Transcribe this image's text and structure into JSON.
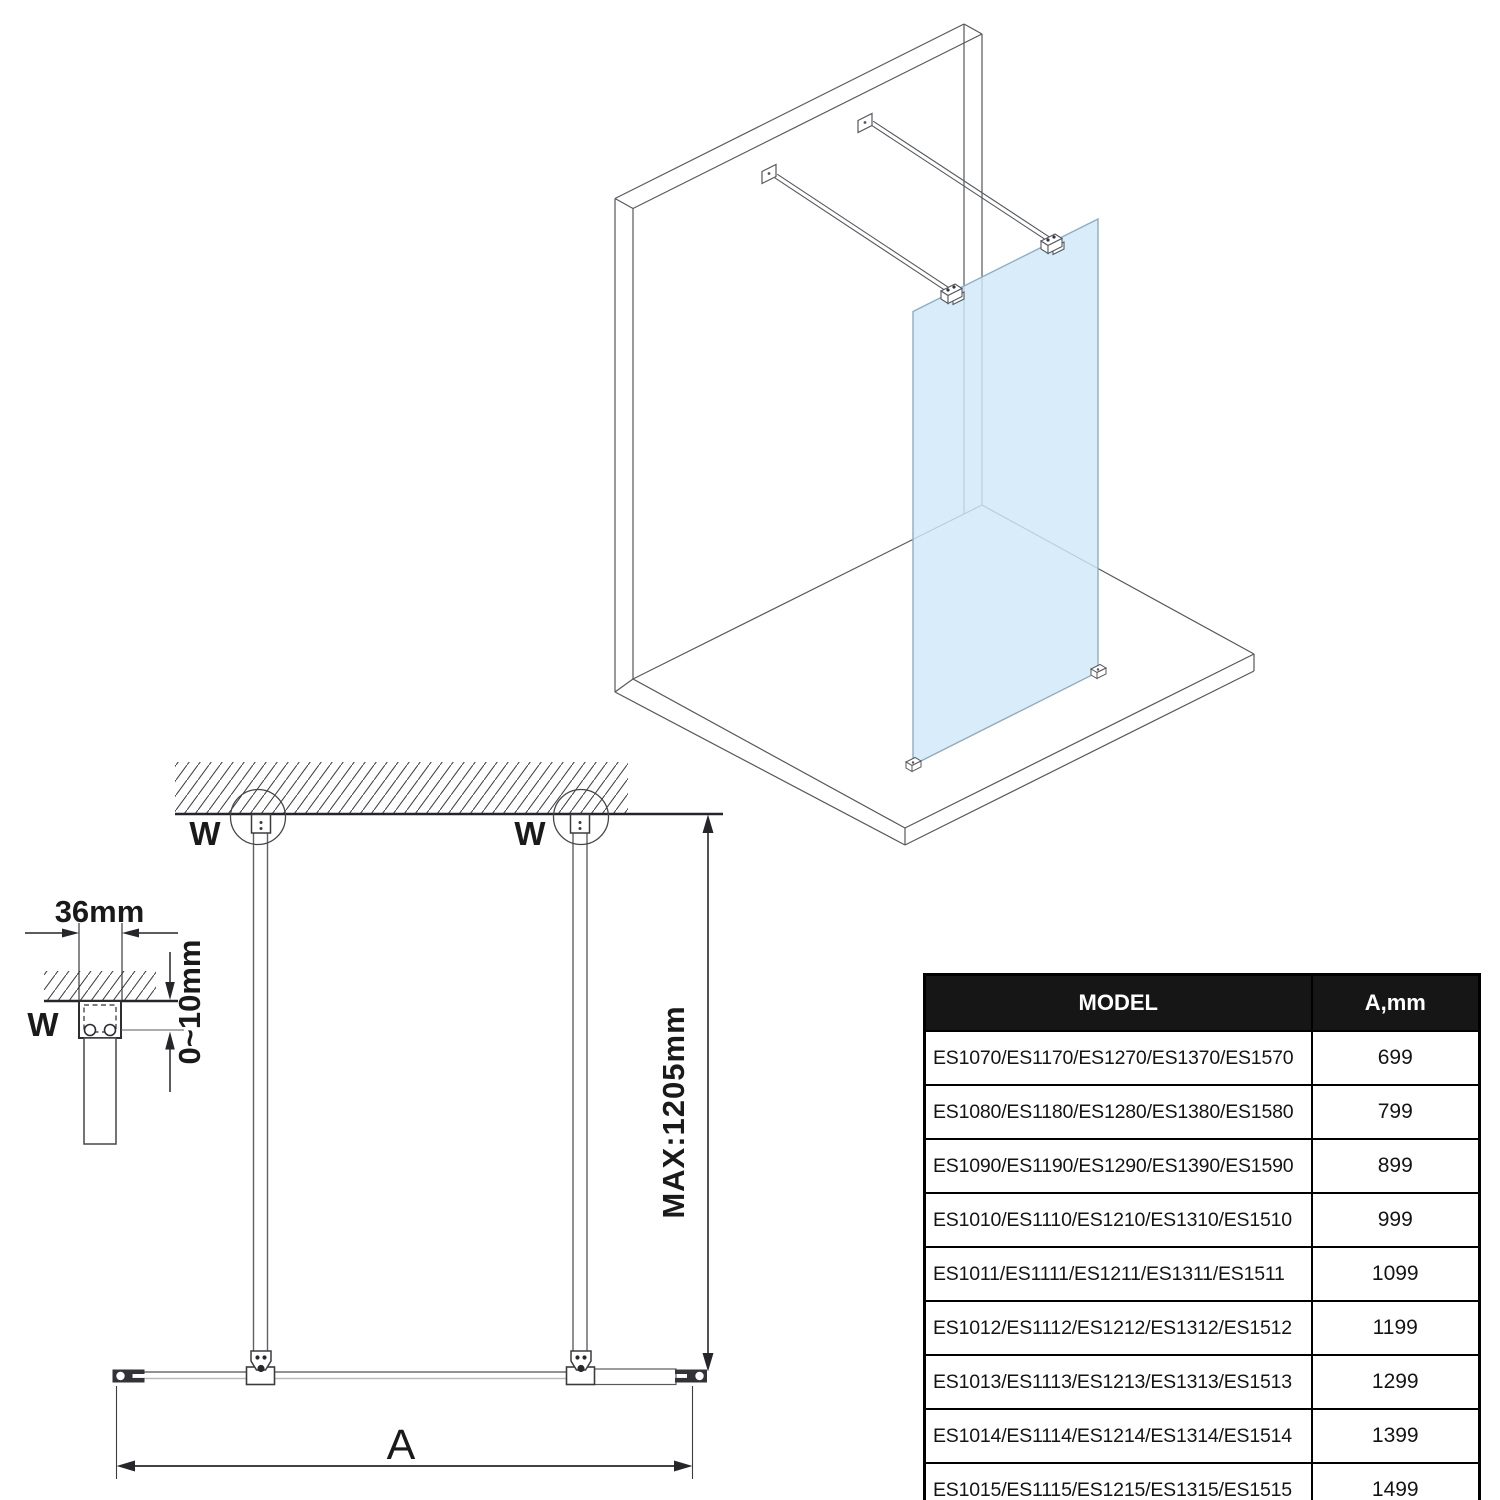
{
  "drawing": {
    "labels": {
      "wall_fixing": "W",
      "glass_width": "A",
      "max_bar_length": "MAX:1205mm",
      "bracket_width": "36mm",
      "adjustment_range": "0~10mm"
    },
    "colors": {
      "glass_fill": "#cfe9f8",
      "glass_edge": "#90acc0",
      "line_2d": "#26262a",
      "line_3d": "#55585e",
      "fitting_dark": "#343438"
    }
  },
  "table": {
    "headers": {
      "model": "MODEL",
      "a_mm": "A,mm"
    },
    "rows": [
      {
        "model": "ES1070/ES1170/ES1270/ES1370/ES1570",
        "a": "699"
      },
      {
        "model": "ES1080/ES1180/ES1280/ES1380/ES1580",
        "a": "799"
      },
      {
        "model": "ES1090/ES1190/ES1290/ES1390/ES1590",
        "a": "899"
      },
      {
        "model": "ES1010/ES1110/ES1210/ES1310/ES1510",
        "a": "999"
      },
      {
        "model": "ES1011/ES1111/ES1211/ES1311/ES1511",
        "a": "1099"
      },
      {
        "model": "ES1012/ES1112/ES1212/ES1312/ES1512",
        "a": "1199"
      },
      {
        "model": "ES1013/ES1113/ES1213/ES1313/ES1513",
        "a": "1299"
      },
      {
        "model": "ES1014/ES1114/ES1214/ES1314/ES1514",
        "a": "1399"
      },
      {
        "model": "ES1015/ES1115/ES1215/ES1315/ES1515",
        "a": "1499"
      }
    ]
  }
}
